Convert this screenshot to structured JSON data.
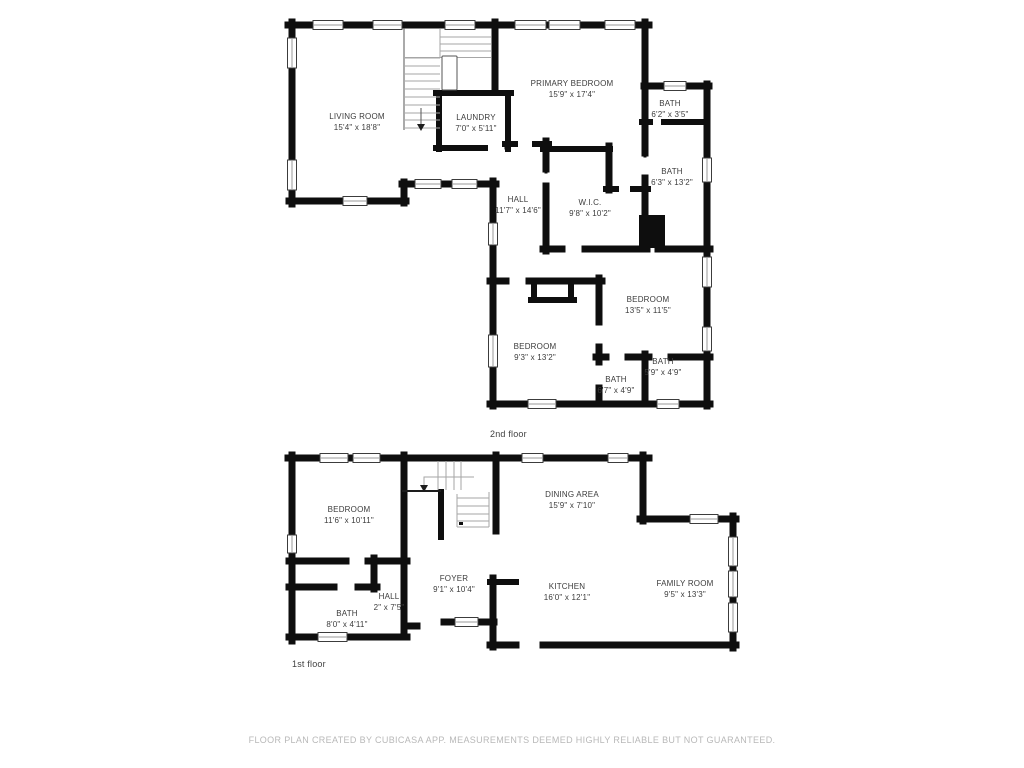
{
  "canvas": {
    "background": "#ffffff"
  },
  "colors": {
    "wall": "#0e0e0e",
    "stair_lines": "#a6a6a6",
    "room_label_text": "#3c3c3c",
    "floor_label_text": "#414141",
    "disclaimer_text": "#b8b8b8"
  },
  "floors": [
    {
      "label": "2nd floor",
      "rooms": [
        {
          "name": "LIVING ROOM",
          "dims": "15'4\" x 18'8\""
        },
        {
          "name": "LAUNDRY",
          "dims": "7'0\" x 5'11\""
        },
        {
          "name": "PRIMARY BEDROOM",
          "dims": "15'9\" x 17'4\""
        },
        {
          "name": "BATH",
          "dims": "6'2\" x 3'5\""
        },
        {
          "name": "BATH",
          "dims": "6'3\" x 13'2\""
        },
        {
          "name": "HALL",
          "dims": "11'7\" x 14'6\""
        },
        {
          "name": "W.I.C.",
          "dims": "9'8\" x 10'2\""
        },
        {
          "name": "BEDROOM",
          "dims": "13'5\" x 11'5\""
        },
        {
          "name": "BEDROOM",
          "dims": "9'3\" x 13'2\""
        },
        {
          "name": "BATH",
          "dims": "6'7\" x 4'9\""
        },
        {
          "name": "BATH",
          "dims": "5'9\" x 4'9\""
        }
      ]
    },
    {
      "label": "1st floor",
      "rooms": [
        {
          "name": "BEDROOM",
          "dims": "11'6\" x 10'11\""
        },
        {
          "name": "DINING AREA",
          "dims": "15'9\" x 7'10\""
        },
        {
          "name": "FOYER",
          "dims": "9'1\" x 10'4\""
        },
        {
          "name": "KITCHEN",
          "dims": "16'0\" x 12'1\""
        },
        {
          "name": "FAMILY ROOM",
          "dims": "9'5\" x 13'3\""
        },
        {
          "name": "HALL",
          "dims": "2\" x 7'5\""
        },
        {
          "name": "BATH",
          "dims": "8'0\" x 4'11\""
        }
      ]
    }
  ],
  "footer": {
    "disclaimer": "FLOOR PLAN CREATED BY CUBICASA APP. MEASUREMENTS DEEMED HIGHLY RELIABLE BUT NOT GUARANTEED."
  }
}
